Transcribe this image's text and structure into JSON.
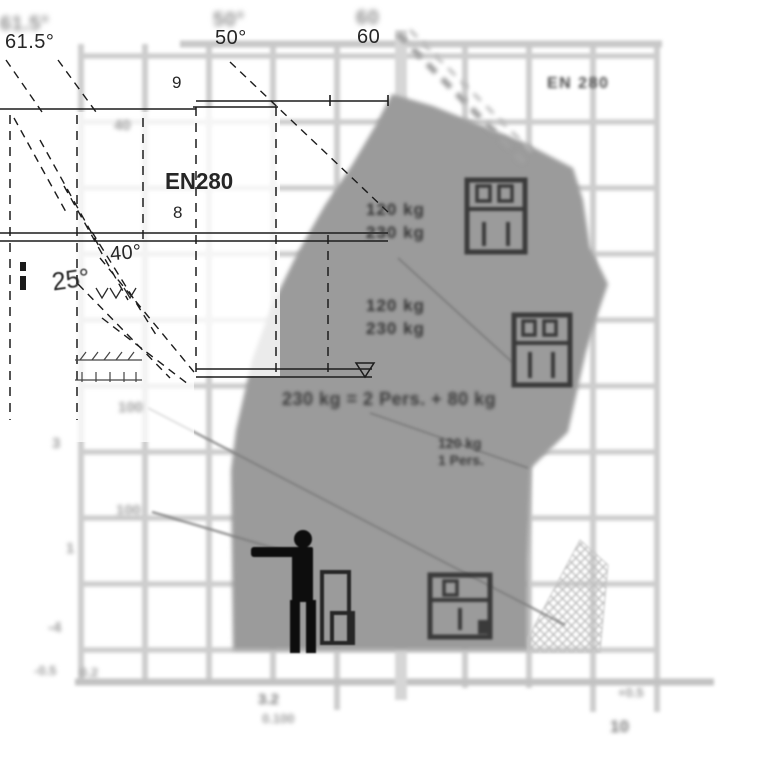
{
  "colors": {
    "envelope": "#9b9b9b",
    "grid": "#cdcdcd",
    "ink": "#1f1f1f",
    "hatch": "#bdbdbd"
  },
  "diagram": {
    "standard_badge": "EN 280",
    "model_label": "EN280",
    "angles": {
      "max_boom": "61.5°",
      "mid_boom": "50°",
      "top_scale": "60",
      "low_boom": "40°",
      "min_boom": "25°"
    },
    "heights": {
      "line9": "9",
      "line8": "8"
    },
    "ghosts": {
      "g615": "61.5°",
      "g50": "50°",
      "g60": "60"
    },
    "zones": {
      "upper": {
        "line1": "120 kg",
        "line2": "230 kg"
      },
      "middle": {
        "line1": "120 kg",
        "line2": "230 kg"
      },
      "capacity_note": "230 kg = 2 Pers. + 80 kg",
      "lower": {
        "line1": "120 kg",
        "line2": "1 Pers."
      }
    },
    "icons": {
      "basket_upper": "basket-2-persons-icon",
      "basket_middle": "basket-2-persons-icon",
      "basket_lower": "basket-1-person-icon",
      "operator": "standing-person-icon"
    },
    "margin_labels": {
      "left_40": "40",
      "left_100a": "100",
      "left_3": "3",
      "left_100b": "100",
      "left_1": "1",
      "left_minus4": "-4",
      "left_minus05": "-0.5",
      "left_02": "0.2",
      "bottom_32": "3.2",
      "bottom_0100": "0.100",
      "bottom_plus05": "+0.5",
      "bottom_10": "10"
    }
  }
}
